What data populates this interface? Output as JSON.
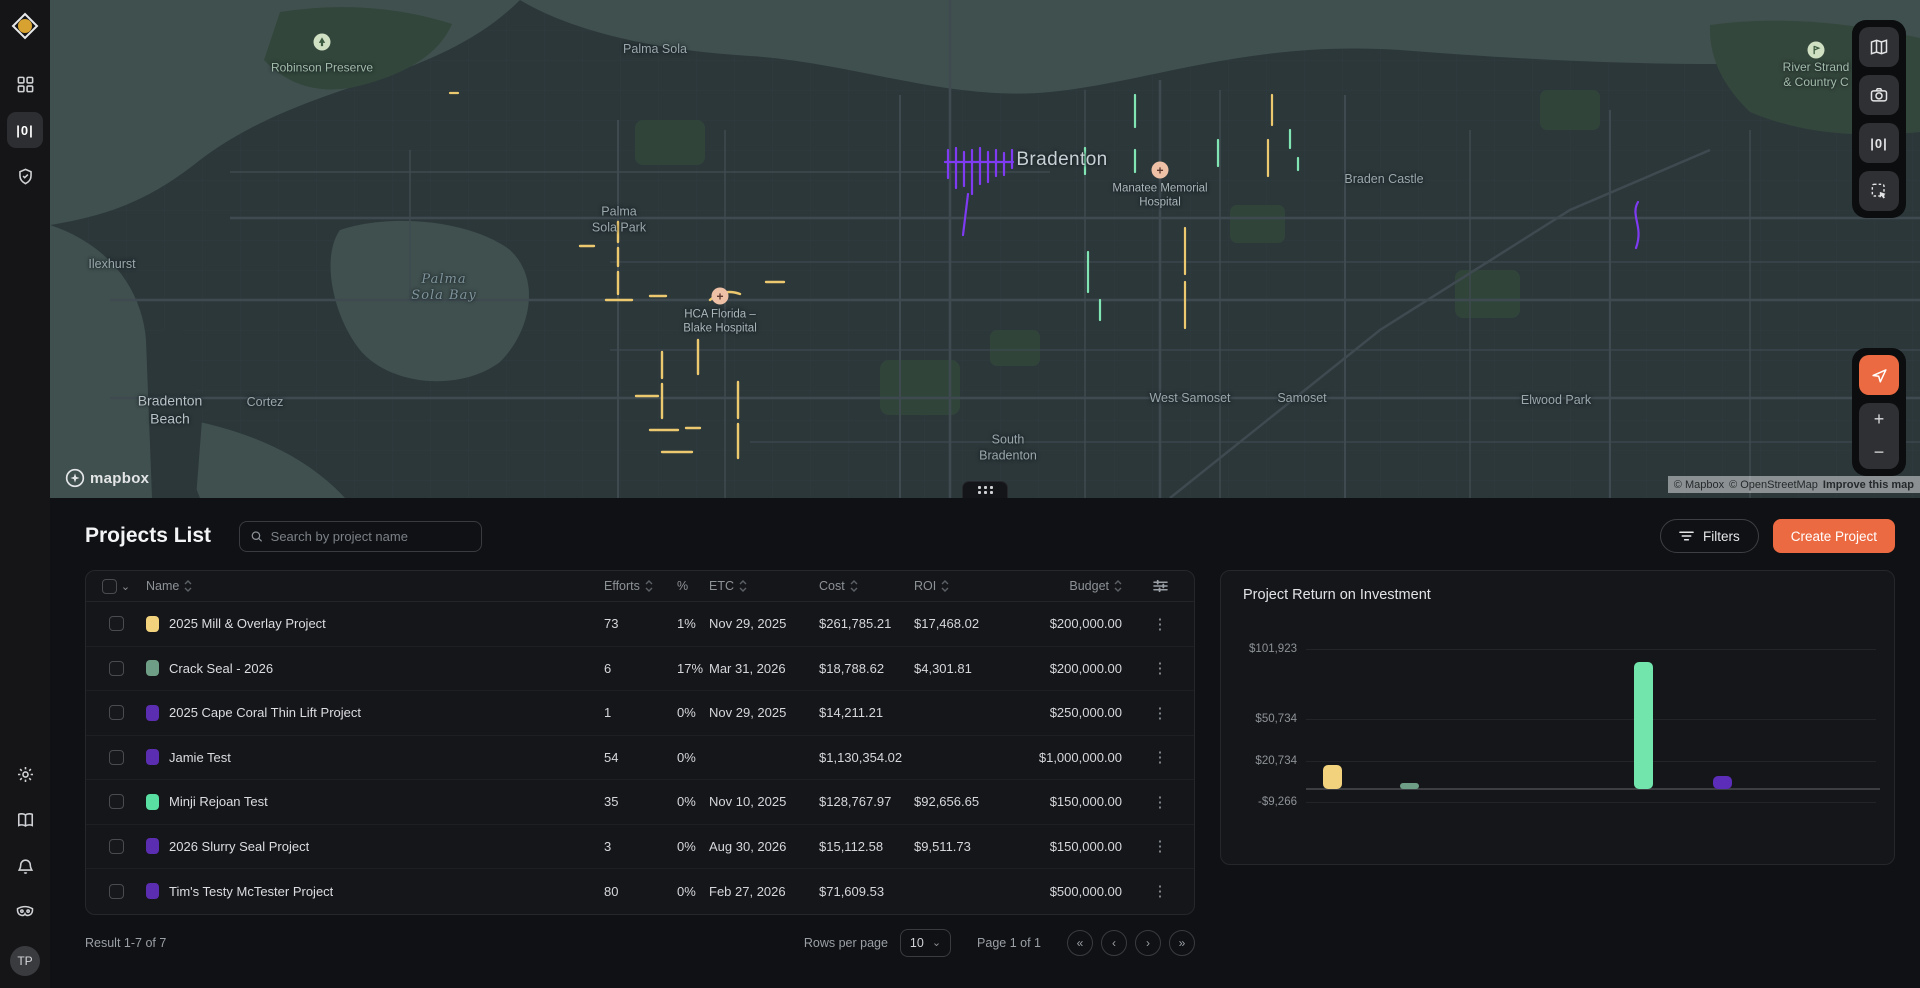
{
  "sidebar": {
    "avatar_initials": "TP",
    "items_top": [
      "dashboard",
      "projects",
      "compliance"
    ],
    "items_bottom": [
      "settings",
      "docs",
      "notifications",
      "mask"
    ]
  },
  "map": {
    "labels": [
      {
        "text": "Robinson Preserve",
        "x": 272,
        "y": 68,
        "cls": "park",
        "icon": "tree",
        "iy": 42
      },
      {
        "text": "Palma Sola",
        "x": 605,
        "y": 50,
        "cls": "suburb"
      },
      {
        "text": "Bradenton",
        "x": 1012,
        "y": 160,
        "cls": "city"
      },
      {
        "text": "Manatee Memorial\nHospital",
        "x": 1110,
        "y": 196,
        "cls": "poi",
        "icon": "hospital",
        "iy": 170
      },
      {
        "text": "Palma\nSola Park",
        "x": 569,
        "y": 220,
        "cls": "suburb"
      },
      {
        "text": "Palma\nSola Bay",
        "x": 394,
        "y": 288,
        "cls": "water"
      },
      {
        "text": "Ilexhurst",
        "x": 62,
        "y": 265,
        "cls": "suburb"
      },
      {
        "text": "HCA Florida –\nBlake Hospital",
        "x": 670,
        "y": 322,
        "cls": "poi",
        "icon": "hospital",
        "iy": 296
      },
      {
        "text": "Bradenton\nBeach",
        "x": 120,
        "y": 410,
        "cls": "bigtown"
      },
      {
        "text": "Cortez",
        "x": 215,
        "y": 403,
        "cls": "suburb"
      },
      {
        "text": "West Samoset",
        "x": 1140,
        "y": 399,
        "cls": "suburb"
      },
      {
        "text": "Samoset",
        "x": 1252,
        "y": 399,
        "cls": "suburb"
      },
      {
        "text": "South\nBradenton",
        "x": 958,
        "y": 448,
        "cls": "suburb"
      },
      {
        "text": "Braden Castle",
        "x": 1334,
        "y": 180,
        "cls": "suburb"
      },
      {
        "text": "Elwood Park",
        "x": 1506,
        "y": 401,
        "cls": "suburb"
      },
      {
        "text": "River Strand\n& Country C",
        "x": 1766,
        "y": 75,
        "cls": "park",
        "icon": "golf",
        "iy": 50
      }
    ],
    "routes": [
      {
        "color": "#7e3bf2",
        "w": 2.2,
        "d": "M895 162 h68 M898 150 v28 M906 148 v40 M914 152 v34 M922 150 v44 M930 148 v36 M938 152 v30 M946 150 v26 M954 153 v22 M962 150 v18 M918 194 l-5 41"
      },
      {
        "color": "#ecc86e",
        "w": 2.4,
        "d": "M568 222 v20 M568 248 v18 M568 272 v22 M556 300 h26 M600 296 h16 M612 352 v26 M612 384 v34 M586 396 h22 M648 340 v34 M600 430 h28 M636 428 h14 M688 382 v36 M688 424 v34 M660 300 q14 -12 30 -6 M716 282 h18 M530 246 h14 M612 452 h30"
      },
      {
        "color": "#80e5b2",
        "w": 2.2,
        "d": "M1035 148 v26 M1038 252 v40 M1085 95 v32 M1085 150 v22 M1168 140 v26 M1050 300 v20 M1240 130 v18 M1248 158 v12"
      },
      {
        "color": "#ecc86e",
        "w": 2.2,
        "d": "M1135 228 v46 M1135 282 v46 M1222 95 v30 M1218 140 v36 M400 93 h8"
      },
      {
        "color": "#7e3bf2",
        "w": 2.2,
        "d": "M1588 202 c -8 14 6 24 -2 46"
      }
    ],
    "attribution": {
      "mapbox": "© Mapbox",
      "osm": "© OpenStreetMap",
      "improve": "Improve this map"
    },
    "logo_text": "mapbox"
  },
  "projects": {
    "title": "Projects List",
    "search_placeholder": "Search by project name",
    "filters_label": "Filters",
    "create_label": "Create Project",
    "columns": [
      {
        "label": "Name",
        "sortable": true
      },
      {
        "label": "Efforts",
        "sortable": true
      },
      {
        "label": "%",
        "sortable": false
      },
      {
        "label": "ETC",
        "sortable": true
      },
      {
        "label": "Cost",
        "sortable": true
      },
      {
        "label": "ROI",
        "sortable": true
      },
      {
        "label": "Budget",
        "sortable": true
      }
    ],
    "rows": [
      {
        "name": "2025 Mill & Overlay Project",
        "color": "#f2d27d",
        "efforts": "73",
        "pct": "1%",
        "etc": "Nov 29, 2025",
        "cost": "$261,785.21",
        "roi": "$17,468.02",
        "budget": "$200,000.00"
      },
      {
        "name": "Crack Seal - 2026",
        "color": "#6e9e85",
        "efforts": "6",
        "pct": "17%",
        "etc": "Mar 31, 2026",
        "cost": "$18,788.62",
        "roi": "$4,301.81",
        "budget": "$200,000.00"
      },
      {
        "name": "2025 Cape Coral Thin Lift Project",
        "color": "#5b2db0",
        "efforts": "1",
        "pct": "0%",
        "etc": "Nov 29, 2025",
        "cost": "$14,211.21",
        "roi": "",
        "budget": "$250,000.00"
      },
      {
        "name": "Jamie Test",
        "color": "#5b2db0",
        "efforts": "54",
        "pct": "0%",
        "etc": "",
        "cost": "$1,130,354.02",
        "roi": "",
        "budget": "$1,000,000.00"
      },
      {
        "name": "Minji Rejoan Test",
        "color": "#59dfa2",
        "efforts": "35",
        "pct": "0%",
        "etc": "Nov 10, 2025",
        "cost": "$128,767.97",
        "roi": "$92,656.65",
        "budget": "$150,000.00"
      },
      {
        "name": "2026 Slurry Seal Project",
        "color": "#5b2db0",
        "efforts": "3",
        "pct": "0%",
        "etc": "Aug 30, 2026",
        "cost": "$15,112.58",
        "roi": "$9,511.73",
        "budget": "$150,000.00"
      },
      {
        "name": "Tim's Testy McTester Project",
        "color": "#5b2db0",
        "efforts": "80",
        "pct": "0%",
        "etc": "Feb 27, 2026",
        "cost": "$71,609.53",
        "roi": "",
        "budget": "$500,000.00"
      }
    ],
    "footer": {
      "result": "Result 1-7 of 7",
      "rows_per_page_label": "Rows per page",
      "rows_per_page_value": "10",
      "page": "Page 1 of 1",
      "pager": [
        "«",
        "‹",
        "›",
        "»"
      ]
    }
  },
  "chart_data": {
    "type": "bar",
    "title": "Project Return on Investment",
    "ylabel": "ROI ($)",
    "grid": true,
    "legend": "none",
    "axis": {
      "baseline_px": 218,
      "ref_px": 78,
      "ref_value": 101923
    },
    "yticks": [
      {
        "label": "$101,923",
        "value": 101923
      },
      {
        "label": "$50,734",
        "value": 50734
      },
      {
        "label": "$20,734",
        "value": 20734
      },
      {
        "label": "-$9,266",
        "value": -9266
      }
    ],
    "series": [
      {
        "name": "2025 Mill & Overlay Project",
        "value": 17468.02,
        "color": "#f2d27d",
        "x_frac": 0.03
      },
      {
        "name": "Crack Seal - 2026",
        "value": 4301.81,
        "color": "#6e9e85",
        "x_frac": 0.165
      },
      {
        "name": "Minji Rejoan Test",
        "value": 92656.65,
        "color": "#72e5ad",
        "x_frac": 0.575
      },
      {
        "name": "2026 Slurry Seal Project",
        "value": 9511.73,
        "color": "#5b2db8",
        "x_frac": 0.714
      }
    ]
  }
}
